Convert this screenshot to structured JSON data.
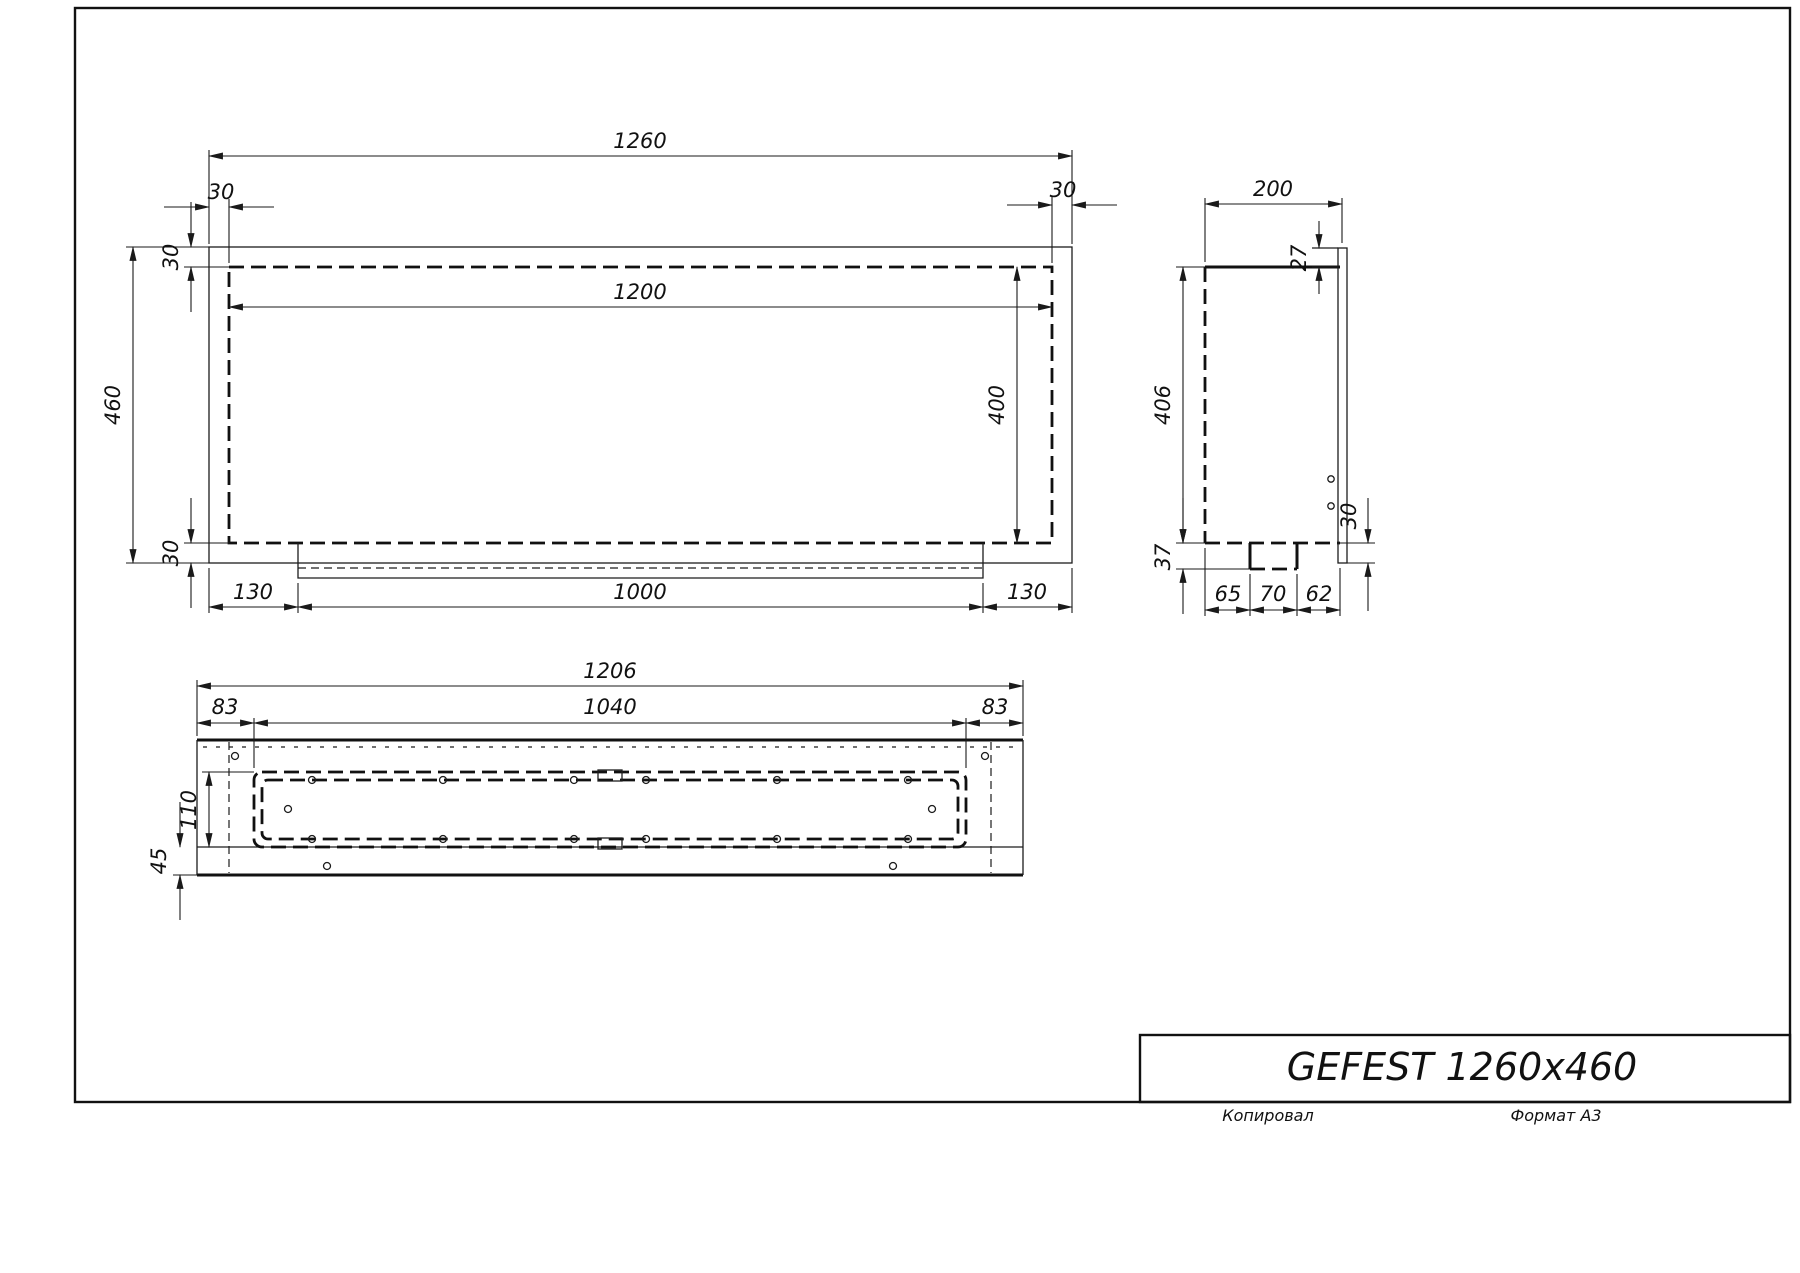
{
  "sheet": {
    "title": "GEFEST 1260x460",
    "footer_left": "Копировал",
    "footer_right": "Формат А3"
  },
  "front_view": {
    "dims": {
      "overall_width": "1260",
      "offset_top_left": "30",
      "offset_top_right": "30",
      "inner_width": "1200",
      "overall_height": "460",
      "flange_top": "30",
      "flange_bottom": "30",
      "inner_height": "400",
      "bottom_left_margin": "130",
      "burner_width": "1000",
      "bottom_right_margin": "130"
    }
  },
  "side_view": {
    "dims": {
      "depth": "200",
      "flange_top_offset": "27",
      "body_height": "406",
      "tray_depth": "37",
      "flange_bottom_offset": "30",
      "seg_left": "65",
      "seg_center": "70",
      "seg_right": "62"
    }
  },
  "bottom_view": {
    "dims": {
      "overall_width": "1206",
      "margin_left": "83",
      "opening_width": "1040",
      "margin_right": "83",
      "opening_depth": "110",
      "front_offset": "45"
    }
  }
}
